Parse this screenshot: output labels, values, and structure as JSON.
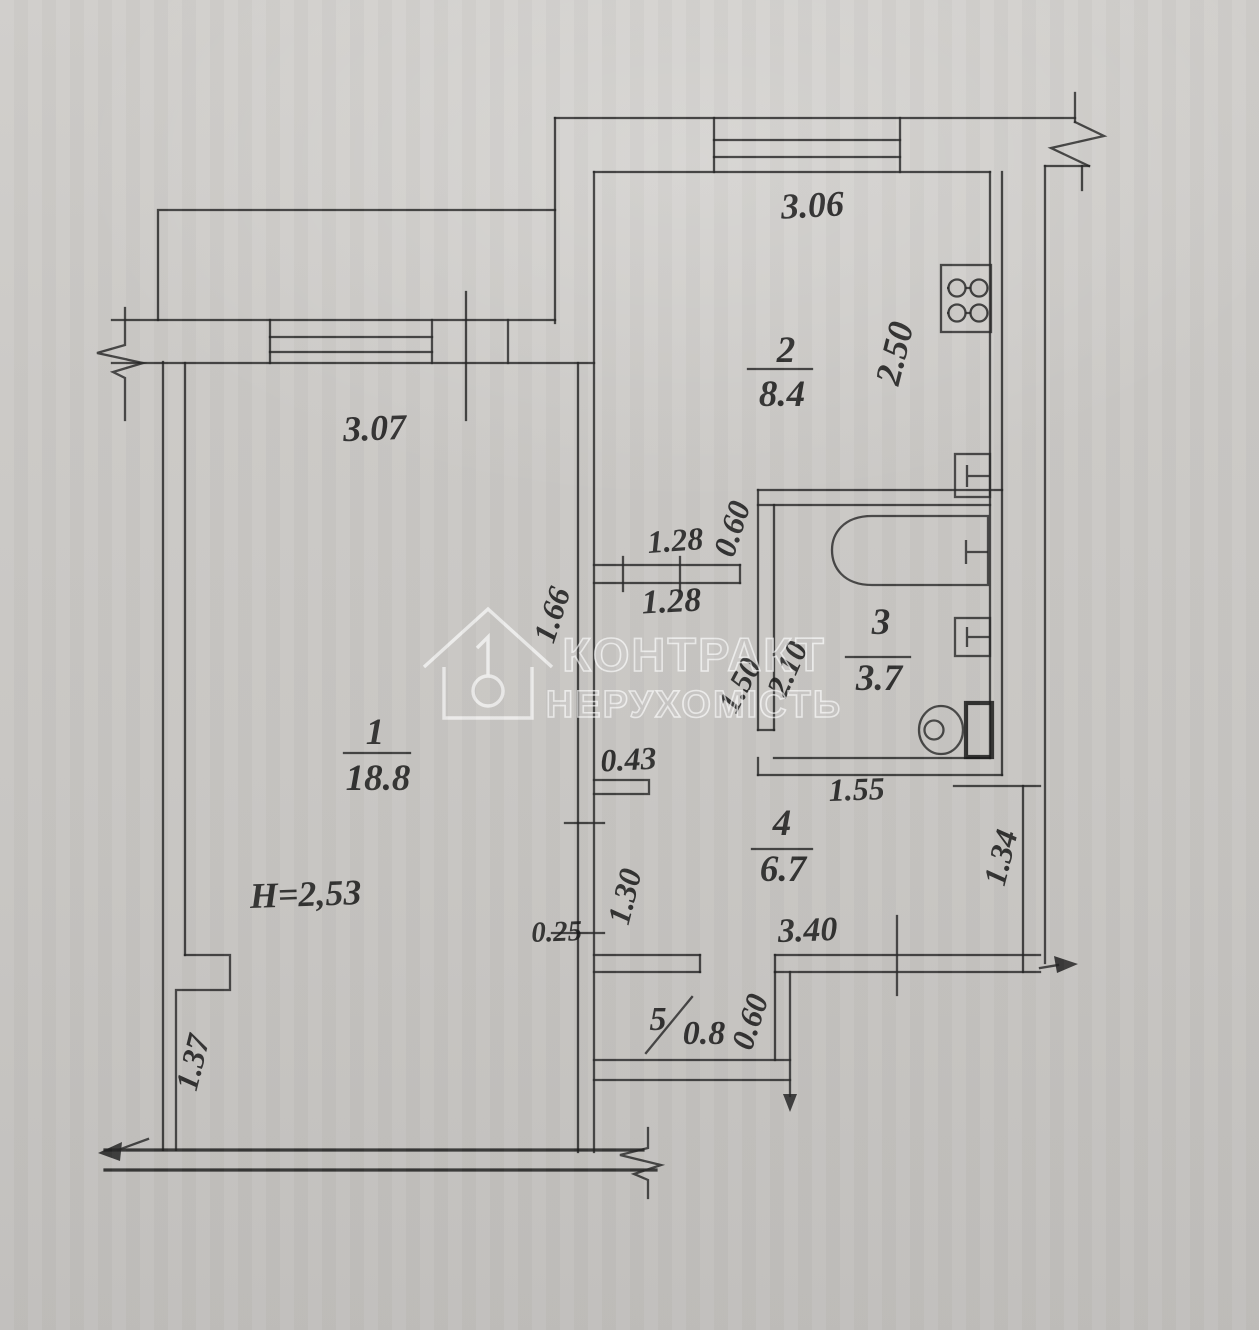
{
  "document": {
    "type": "apartment floor plan (BTI technical drawing)"
  },
  "rooms": {
    "r1": {
      "number": "1",
      "area": "18.8"
    },
    "r2": {
      "number": "2",
      "area": "8.4"
    },
    "r3": {
      "number": "3",
      "area": "3.7"
    },
    "r4": {
      "number": "4",
      "area": "6.7"
    },
    "r5": {
      "number": "5",
      "area": "0.8"
    }
  },
  "notes": {
    "ceiling_height": "H=2,53"
  },
  "dims": {
    "d306": "3.06",
    "d250": "2.50",
    "d307": "3.07",
    "d128a": "1.28",
    "d128b": "1.28",
    "d060a": "0.60",
    "d060b": "0.60",
    "d166": "1.66",
    "d150": "1.50",
    "d210": "2.10",
    "d043": "0.43",
    "d155": "1.55",
    "d130": "1.30",
    "d025": "0.25",
    "d340": "3.40",
    "d134": "1.34",
    "d137": "1.37"
  },
  "watermark": {
    "line1": "КОНТРАКТ",
    "line2": "НЕРУХОМІСТЬ"
  },
  "fixtures": [
    "stove",
    "sink",
    "bathtub",
    "washbasin",
    "toilet"
  ],
  "colors": {
    "paper": "#cbc9c6",
    "ink": "#262626",
    "watermark": "#ffffff"
  }
}
